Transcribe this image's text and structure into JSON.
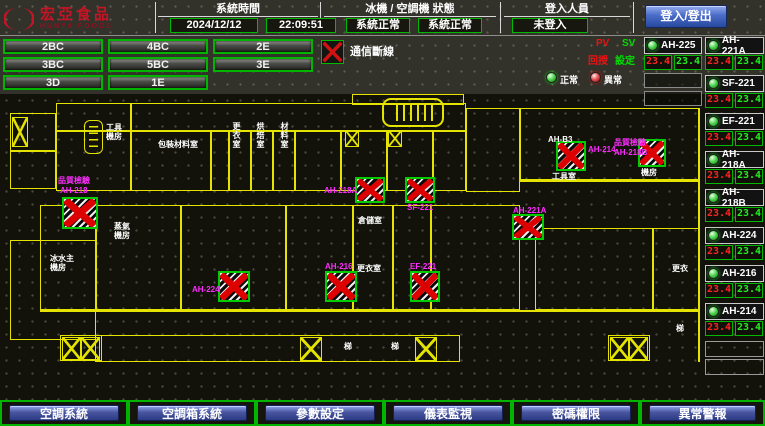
{
  "header": {
    "logo_title": "宏亞食品",
    "logo_subtitle": "HUNYA FOODS",
    "system_time_label": "系統時間",
    "date": "2024/12/12",
    "time": "22:09:51",
    "machine_status_label": "冰機 / 空調機 狀態",
    "chiller_status": "系統正常",
    "ahu_status": "系統正常",
    "login_label": "登入人員",
    "login_status": "未登入",
    "login_button_label": "登入/登出"
  },
  "floor_buttons": [
    "2BC",
    "4BC",
    "2E",
    "3BC",
    "5BC",
    "3E",
    "3D",
    "1E"
  ],
  "legend": {
    "comm_fault_label": "通信斷線",
    "pv_abbr": "PV",
    "sv_abbr": "SV",
    "pv_label": "回授",
    "sv_label": "設定",
    "normal_label": "正常",
    "abnormal_label": "異常"
  },
  "equipment_units": [
    {
      "name": "AH-225",
      "pv": "23.4",
      "sv": "23.4"
    },
    {
      "name": "AH-221A",
      "pv": "23.4",
      "sv": "23.4"
    },
    {
      "name": "SF-221",
      "pv": "23.4",
      "sv": "23.4"
    },
    {
      "name": "EF-221",
      "pv": "23.4",
      "sv": "23.4"
    },
    {
      "name": "AH-218A",
      "pv": "23.4",
      "sv": "23.4"
    },
    {
      "name": "AH-218B",
      "pv": "23.4",
      "sv": "23.4"
    },
    {
      "name": "AH-224",
      "pv": "23.4",
      "sv": "23.4"
    },
    {
      "name": "AH-216",
      "pv": "23.4",
      "sv": "23.4"
    },
    {
      "name": "AH-214",
      "pv": "23.4",
      "sv": "23.4"
    }
  ],
  "map": {
    "device_labels": [
      "品質檢驗",
      "AH-218",
      "AH-224",
      "AH-216",
      "EF-221",
      "AH-218A",
      "SF-221",
      "AH-221A",
      "AH-214",
      "品質檢驗",
      "AH-218B"
    ],
    "room_labels": [
      "AH-B3",
      "包裝材料室",
      "工具機房",
      "更衣室",
      "烘焙室",
      "材料室",
      "蒸氣機房",
      "冰水主機房",
      "倉儲室",
      "更衣室",
      "工具室",
      "機房",
      "梯",
      "梯",
      "更衣",
      "梯"
    ]
  },
  "nav_buttons": [
    "空調系統",
    "空調箱系統",
    "參數設定",
    "儀表監視",
    "密碼權限",
    "異常警報"
  ]
}
